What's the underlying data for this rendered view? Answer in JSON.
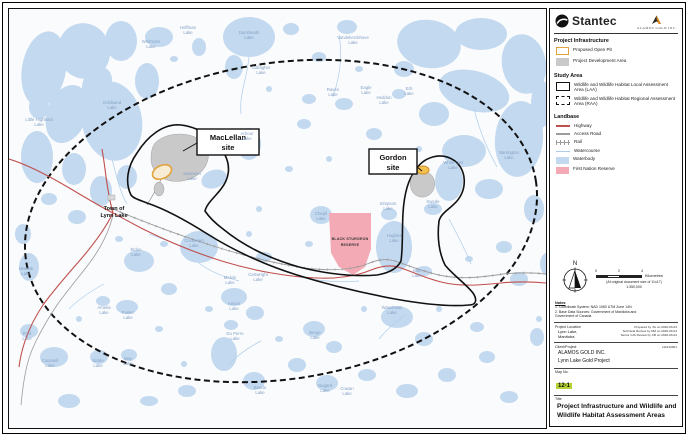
{
  "header": {
    "stantec_logo": "Stantec",
    "alamos_logo": "Alamos Gold Inc."
  },
  "legend": {
    "sections": [
      {
        "title": "Project Infrastructure",
        "items": [
          {
            "label": "Proposed Open Pit",
            "swatch": "open-pit"
          },
          {
            "label": "Project Development Area",
            "swatch": "dev-area"
          }
        ]
      },
      {
        "title": "Study Area",
        "items": [
          {
            "label": "Wildlife and Wildlife Habitat Local Assessment Area (LAA)",
            "swatch": "laa"
          },
          {
            "label": "Wildlife and Wildlife Habitat Regional Assessment Area (RAA)",
            "swatch": "raa"
          }
        ]
      },
      {
        "title": "Landbase",
        "items": [
          {
            "label": "Highway",
            "swatch": "highway"
          },
          {
            "label": "Access Road",
            "swatch": "access-road"
          },
          {
            "label": "Rail",
            "swatch": "rail"
          },
          {
            "label": "Watercourse",
            "swatch": "watercourse"
          },
          {
            "label": "Waterbody",
            "swatch": "waterbody"
          },
          {
            "label": "First Nation Reserve",
            "swatch": "first-nation-reserve"
          }
        ]
      }
    ]
  },
  "titleblock": {
    "scale": {
      "ticks": [
        "0",
        "2",
        "4"
      ],
      "unit": "Kilometres",
      "note1": "(At original document size of 11x17)",
      "note2": "1:350,000"
    },
    "notes": {
      "header": "Notes",
      "lines": [
        "1. Coordinate System: NAD 1983 UTM Zone 14N",
        "2. Base Data Sources: Government of Manitoba and",
        "Government of Canada"
      ]
    },
    "project_location": {
      "header": "Project Location",
      "lines": [
        "Lynn Lake,",
        "Manitoba"
      ]
    },
    "review_lines": [
      "Prepared by JG on 2020-03-04",
      "Technical Review by DM on 2020-03-04",
      "Senior GIS Review by CB on 2020-03-04"
    ],
    "client_project": {
      "header": "Client/Project",
      "number": "111410001",
      "lines": [
        "ALAMOS GOLD INC.",
        "Lynn Lake Gold Project"
      ]
    },
    "map_no": {
      "header": "Map No.",
      "value": "12-1"
    },
    "title": {
      "header": "Title",
      "text": "Project Infrastructure and Wildlife and Wildlife Habitat Assessment Areas"
    }
  },
  "map": {
    "sites": {
      "maclellan": {
        "line1": "MacLellan",
        "line2": "site"
      },
      "gordon": {
        "line1": "Gordon",
        "line2": "site"
      }
    },
    "town": {
      "line1": "Town of",
      "line2": "Lynn Lake"
    },
    "reserve": {
      "line1": "BLACK STURGEON",
      "line2": "RESERVE"
    },
    "lake_labels": [
      {
        "text": "Hoffman Lake",
        "x": 179,
        "y": 20
      },
      {
        "text": "Dunsheath Lake",
        "x": 240,
        "y": 25
      },
      {
        "text": "Vandekerckhove Lake",
        "x": 344,
        "y": 30
      },
      {
        "text": "Gallagher Lake",
        "x": 252,
        "y": 60
      },
      {
        "text": "Raven Lake",
        "x": 324,
        "y": 82
      },
      {
        "text": "Eagle Lake",
        "x": 357,
        "y": 80
      },
      {
        "text": "Whitmore Lake",
        "x": 142,
        "y": 34
      },
      {
        "text": "Goldsand Lake",
        "x": 103,
        "y": 95
      },
      {
        "text": "Little Highland Lake",
        "x": 30,
        "y": 112
      },
      {
        "text": "Heddon Lake",
        "x": 375,
        "y": 90
      },
      {
        "text": "Erb Lake",
        "x": 400,
        "y": 81
      },
      {
        "text": "Barrington Lake",
        "x": 500,
        "y": 145
      },
      {
        "text": "Arbour Lake",
        "x": 238,
        "y": 126
      },
      {
        "text": "Swanson Lake",
        "x": 183,
        "y": 166
      },
      {
        "text": "White Owl Lake",
        "x": 444,
        "y": 155
      },
      {
        "text": "Swede Lake",
        "x": 424,
        "y": 194
      },
      {
        "text": "Simpson Lake",
        "x": 379,
        "y": 196
      },
      {
        "text": "Eldon Lake",
        "x": 127,
        "y": 242
      },
      {
        "text": "Cockeram Lake",
        "x": 185,
        "y": 233
      },
      {
        "text": "Chepil Lake",
        "x": 312,
        "y": 206
      },
      {
        "text": "Hughes Lake",
        "x": 385,
        "y": 228
      },
      {
        "text": "Bob Lake",
        "x": 408,
        "y": 263
      },
      {
        "text": "Melvin Lake",
        "x": 221,
        "y": 270
      },
      {
        "text": "Cartwright Lake",
        "x": 249,
        "y": 267
      },
      {
        "text": "Anson Lake",
        "x": 225,
        "y": 296
      },
      {
        "text": "Berge Lake",
        "x": 306,
        "y": 325
      },
      {
        "text": "Wasekwan Lake",
        "x": 383,
        "y": 300
      },
      {
        "text": "Foster Lake",
        "x": 119,
        "y": 305
      },
      {
        "text": "Amelia Lake",
        "x": 95,
        "y": 300
      },
      {
        "text": "Motriuk Lake",
        "x": 17,
        "y": 261
      },
      {
        "text": "Pool Lake",
        "x": 18,
        "y": 326
      },
      {
        "text": "Counsell Lake",
        "x": 41,
        "y": 353
      },
      {
        "text": "Sickle Lake",
        "x": 89,
        "y": 353
      },
      {
        "text": "May Lake",
        "x": 119,
        "y": 351
      },
      {
        "text": "Du Perre Lake",
        "x": 226,
        "y": 326
      },
      {
        "text": "Beede Lake",
        "x": 251,
        "y": 380
      },
      {
        "text": "Dugard Lake",
        "x": 316,
        "y": 378
      },
      {
        "text": "Cowan Lake",
        "x": 338,
        "y": 381
      }
    ]
  },
  "colors": {
    "waterbody": "#c3d9ef",
    "watercourse": "#aecdea",
    "highway": "#c0504d",
    "road": "#9c9c9c",
    "reserve_fill": "#f4aab4",
    "dev_area": "#c9c9c9",
    "pit_stroke": "#e2a23c",
    "boundary": "#111111",
    "map_no_highlight": "#b5d334"
  }
}
